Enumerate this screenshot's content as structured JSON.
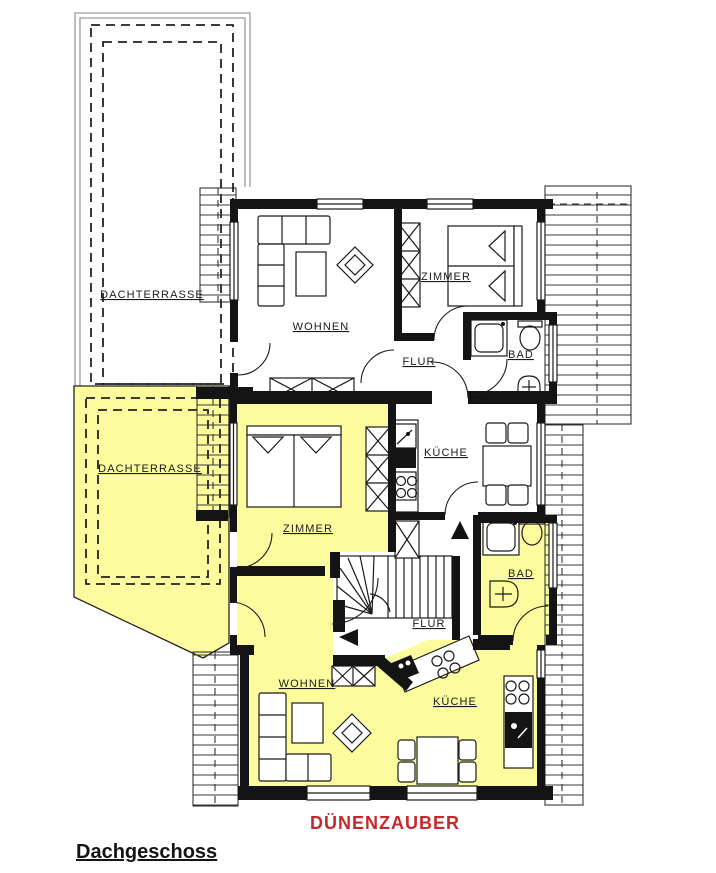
{
  "floor_title": "Dachgeschoss",
  "apartment_name": "DÜNENZAUBER",
  "colors": {
    "apartment_highlight": "#FCFC9E",
    "wall": "#141414",
    "label_red": "#C4292B",
    "terrace_outline": "#9A9A9A"
  },
  "labels": {
    "terrace_upper": "DACHTERRASSE",
    "terrace_lower": "DACHTERRASSE",
    "living_upper": "WOHNEN",
    "bedroom_upper": "ZIMMER",
    "hall_upper": "FLUR",
    "bath_upper": "BAD",
    "kitchen_upper": "KÜCHE",
    "bedroom_lower": "ZIMMER",
    "bath_lower": "BAD",
    "hall_lower": "FLUR",
    "living_lower": "WOHNEN",
    "kitchen_lower": "KÜCHE"
  }
}
